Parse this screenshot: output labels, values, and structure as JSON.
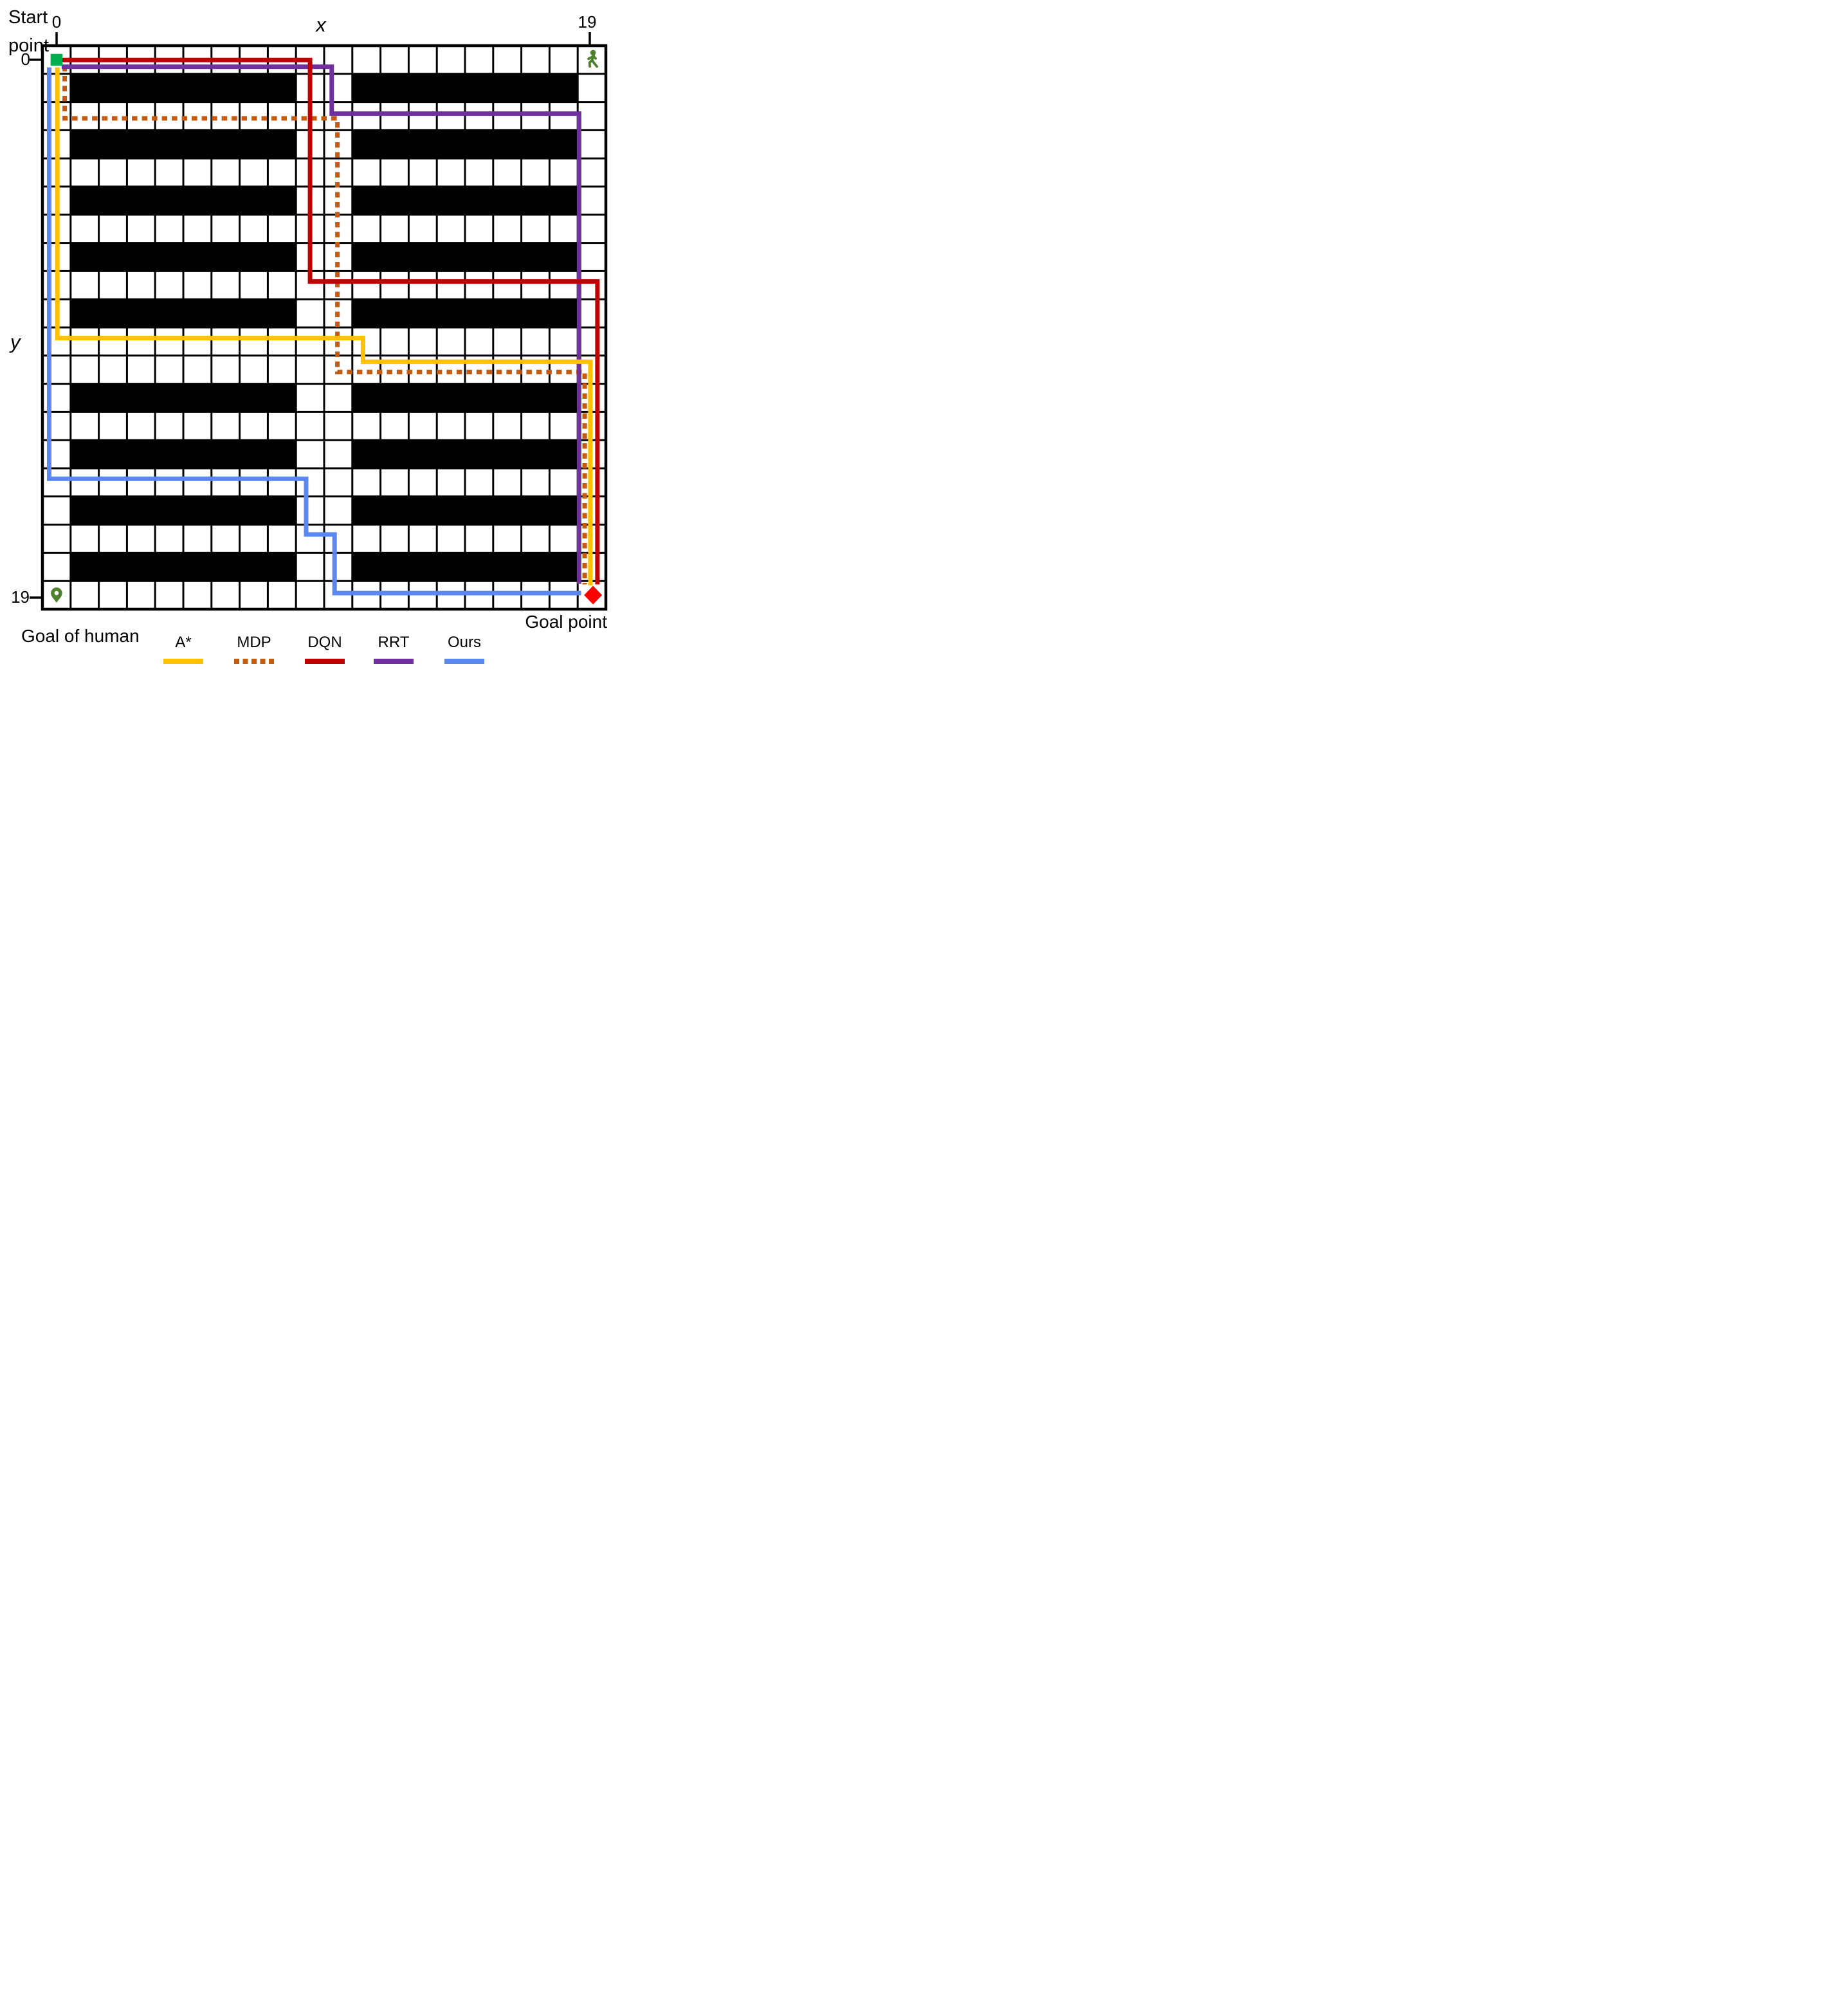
{
  "figure": {
    "start_point_label": "Start\npoint",
    "goal_of_human_label": "Goal of human",
    "goal_point_label": "Goal point"
  },
  "axes": {
    "x_label": "x",
    "y_label": "y",
    "x_tick_first": "0",
    "x_tick_last": "19",
    "y_tick_first": "0",
    "y_tick_last": "19"
  },
  "grid": {
    "cols": 20,
    "rows": 20,
    "line_color": "#000000",
    "obstacle_color": "#000000",
    "obstacle_rows": [
      1,
      3,
      5,
      7,
      9,
      12,
      14,
      16,
      18
    ],
    "obstacle_col_ranges": [
      [
        1,
        8
      ],
      [
        11,
        18
      ]
    ]
  },
  "markers": {
    "start": {
      "cell": [
        0,
        0
      ],
      "shape": "square",
      "color": "#00B050"
    },
    "human_at_start_row": {
      "cell": [
        19,
        0
      ],
      "shape": "walking-person",
      "color": "#4E812E"
    },
    "human_goal": {
      "cell": [
        0,
        19
      ],
      "shape": "map-pin",
      "color": "#4E812E"
    },
    "goal": {
      "cell": [
        19,
        19
      ],
      "shape": "diamond",
      "color": "#FF0000"
    }
  },
  "paths": [
    {
      "name": "MDP",
      "color": "#C55A11",
      "style": "dotted",
      "waypoints": [
        [
          0.29,
          0.22
        ],
        [
          0.29,
          2.08
        ],
        [
          9.97,
          2.08
        ],
        [
          9.97,
          11.08
        ],
        [
          18.75,
          11.08
        ],
        [
          18.75,
          18.62
        ]
      ]
    },
    {
      "name": "RRT",
      "color": "#7030A0",
      "style": "solid",
      "waypoints": [
        [
          0.18,
          0.25
        ],
        [
          9.77,
          0.25
        ],
        [
          9.77,
          1.91
        ],
        [
          18.55,
          1.91
        ],
        [
          18.55,
          18.6
        ]
      ]
    },
    {
      "name": "DQN",
      "color": "#C00000",
      "style": "solid",
      "waypoints": [
        [
          0.18,
          0.01
        ],
        [
          9.0,
          0.01
        ],
        [
          9.0,
          7.87
        ],
        [
          19.2,
          7.87
        ],
        [
          19.2,
          18.62
        ]
      ]
    },
    {
      "name": "A*",
      "color": "#FFC000",
      "style": "solid",
      "waypoints": [
        [
          0.03,
          0.27
        ],
        [
          0.03,
          9.88
        ],
        [
          10.88,
          9.88
        ],
        [
          10.88,
          10.72
        ],
        [
          18.95,
          10.72
        ],
        [
          18.95,
          18.66
        ]
      ]
    },
    {
      "name": "Ours",
      "color": "#5B87F0",
      "style": "solid",
      "waypoints": [
        [
          -0.26,
          0.27
        ],
        [
          -0.26,
          14.87
        ],
        [
          8.86,
          14.87
        ],
        [
          8.86,
          16.85
        ],
        [
          9.87,
          16.85
        ],
        [
          9.87,
          18.93
        ],
        [
          18.62,
          18.93
        ]
      ]
    }
  ],
  "legend": {
    "items": [
      {
        "label": "A*",
        "color": "#FFC000",
        "style": "solid"
      },
      {
        "label": "MDP",
        "color": "#C55A11",
        "style": "dotted"
      },
      {
        "label": "DQN",
        "color": "#C00000",
        "style": "solid"
      },
      {
        "label": "RRT",
        "color": "#7030A0",
        "style": "solid"
      },
      {
        "label": "Ours",
        "color": "#5B87F0",
        "style": "solid"
      }
    ]
  }
}
